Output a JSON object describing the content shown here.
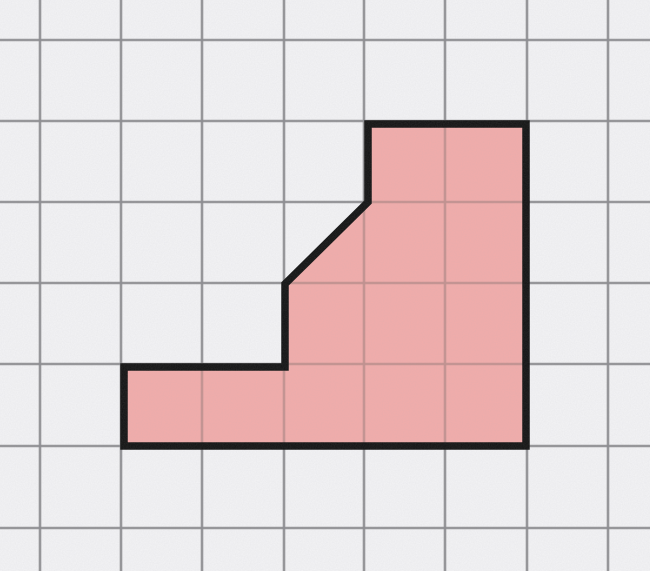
{
  "figure": {
    "title": "shaded-polygon-on-grid-paper",
    "canvas": {
      "width": 650,
      "height": 571
    },
    "grid": {
      "vertical_line_x": [
        40,
        121,
        202,
        284,
        364,
        445,
        527,
        608
      ],
      "horizontal_line_y": [
        40,
        121,
        202,
        283,
        364,
        446,
        528
      ],
      "cell_size_px": 81,
      "line_color": "#8c8c90",
      "line_color_inside_shape": "#c2908e",
      "line_width_px": 2.6,
      "paper_color": "#f4f4f6"
    },
    "polygon": {
      "fill_color": "#f3acaa",
      "outline_color": "#101010",
      "outline_width_px": 7.5,
      "vertices_px": [
        [
          368,
          124
        ],
        [
          526,
          124
        ],
        [
          526,
          446
        ],
        [
          124,
          446
        ],
        [
          124,
          367
        ],
        [
          285,
          367
        ],
        [
          285,
          284
        ],
        [
          368,
          202
        ]
      ],
      "vertices_grid_units": [
        [
          4,
          1
        ],
        [
          6,
          1
        ],
        [
          6,
          5
        ],
        [
          1,
          5
        ],
        [
          1,
          4
        ],
        [
          3,
          4
        ],
        [
          3,
          3
        ],
        [
          4,
          2
        ]
      ]
    }
  }
}
